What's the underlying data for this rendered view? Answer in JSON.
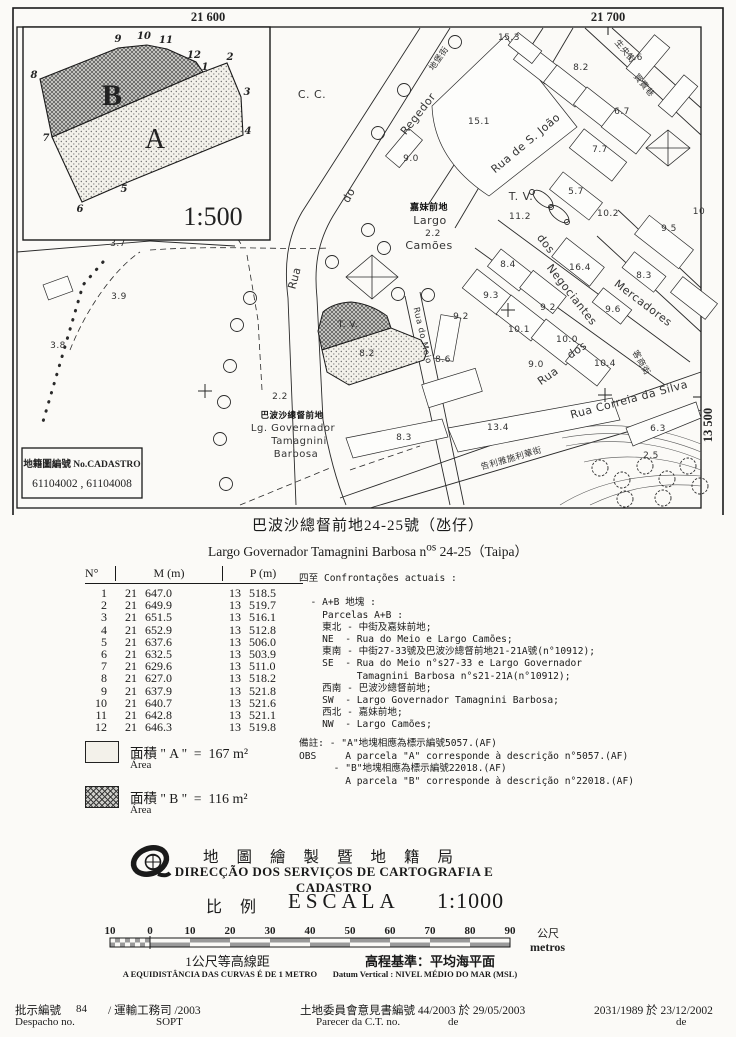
{
  "doc": {
    "title_zh": "巴波沙總督前地24-25號（氹仔）",
    "title_pt_prefix": "Largo Governador Tamagnini Barbosa n",
    "title_pt_sup": "os",
    "title_pt_rest": " 24-25（Taipa）"
  },
  "map": {
    "grid": {
      "top_left": "21 600",
      "top_right": "21 700",
      "right": "13 500"
    },
    "cadastro_box": {
      "line1": "地籍圖編號 No.CADASTRO",
      "line2": "61104002 , 61104008"
    },
    "inset": {
      "scale": "1:500",
      "label_a": "A",
      "label_b": "B",
      "a_d": "M203,72 L227,63 L241,97 L243,135 L128,182 L82,202 L52,137 Z",
      "b_d": "M40,79 L118,48 L147,45 L167,49 L196,62 L203,72 L52,137 Z",
      "vertices": [
        [
          "1",
          205,
          70
        ],
        [
          "2",
          230,
          60
        ],
        [
          "3",
          247,
          95
        ],
        [
          "4",
          248,
          134
        ],
        [
          "5",
          124,
          192
        ],
        [
          "6",
          80,
          212
        ],
        [
          "7",
          46,
          141
        ],
        [
          "8",
          34,
          78
        ],
        [
          "9",
          118,
          42
        ],
        [
          "10",
          144,
          39
        ],
        [
          "11",
          166,
          43
        ],
        [
          "12",
          194,
          58
        ]
      ]
    },
    "parcel_a_d": "M322,350 L391,328 L421,340 L427,351 L424,360 L349,385 L327,372 Z",
    "parcel_b_d": "M318,331 L323,312 Q333,303 351,302 Q371,304 387,316 L391,328 L322,350 Z",
    "streets": [
      "M420,28 L302,212 C287,238 284,266 288,298 L296,505",
      "M450,28 L333,216 C317,243 314,268 317,298 L323,420",
      "M323,420 C330,460 338,485 346,505",
      "M543,28 L428,205",
      "M573,28 L455,228",
      "M498,220 L690,362",
      "M475,248 L665,385",
      "M618,210 L701,288",
      "M597,236 L701,332",
      "M340,498 L701,372",
      "M370,508 L701,410",
      "M405,296 L450,505",
      "M420,292 L464,505",
      "M585,28 L701,135",
      "M612,28 L701,108",
      "M17,252 L150,241",
      "M150,241 L235,246"
    ],
    "dashed": [
      "M100,30 L243,247",
      "M150,250 C220,245 280,250 330,248",
      "M247,255 L258,320 L262,390",
      "M70,350 C90,300 120,265 140,252",
      "M240,505 L330,468",
      "M350,470 L420,446"
    ],
    "dotlines": [
      "M103,262 L83,285 L42,425"
    ],
    "contours": [
      "M560,430 C615,420 660,428 701,444",
      "M562,438 C615,428 662,436 701,452",
      "M566,446 C618,436 664,444 701,460",
      "M584,462 C625,452 668,458 701,470",
      "M560,505 C600,480 650,472 701,476",
      "M590,505 C625,488 660,482 701,486"
    ],
    "building_polys": [
      "M505,36 L577,127 L489,196 Q434,160 432,106 Z",
      "M448,428 L612,398 L620,420 L458,452 Z",
      "M346,438 L442,419 L448,437 L353,458 Z",
      "M626,428 L696,402 L701,418 L633,446 Z"
    ],
    "buildings": [
      [
        536,
        63,
        40,
        22,
        38
      ],
      [
        566,
        86,
        40,
        22,
        38
      ],
      [
        596,
        108,
        40,
        22,
        38
      ],
      [
        626,
        131,
        44,
        24,
        38
      ],
      [
        598,
        155,
        54,
        24,
        38
      ],
      [
        576,
        196,
        50,
        22,
        38
      ],
      [
        648,
        58,
        44,
        20,
        -50
      ],
      [
        678,
        96,
        40,
        18,
        -50
      ],
      [
        404,
        148,
        36,
        18,
        -50
      ],
      [
        525,
        48,
        30,
        16,
        38
      ],
      [
        510,
        270,
        40,
        22,
        38
      ],
      [
        543,
        292,
        42,
        22,
        38
      ],
      [
        578,
        262,
        48,
        24,
        38
      ],
      [
        644,
        272,
        40,
        20,
        38
      ],
      [
        487,
        292,
        44,
        24,
        38
      ],
      [
        521,
        318,
        44,
        24,
        38
      ],
      [
        556,
        342,
        44,
        24,
        38
      ],
      [
        588,
        365,
        40,
        22,
        38
      ],
      [
        612,
        306,
        36,
        18,
        38
      ],
      [
        664,
        242,
        56,
        24,
        38
      ],
      [
        694,
        298,
        44,
        20,
        38
      ],
      [
        452,
        388,
        56,
        24,
        -17
      ],
      [
        447,
        338,
        20,
        44,
        10
      ],
      [
        58,
        288,
        26,
        16,
        -20
      ]
    ],
    "xdiamonds": [
      "M372,255 L398,277 L372,299 L346,277 Z M346,277 L398,277 M372,255 L372,299",
      "M668,130 L690,148 L668,166 L646,148 Z M646,148 L690,148 M668,130 L668,166"
    ],
    "trees": [
      [
        455,
        42
      ],
      [
        404,
        90
      ],
      [
        378,
        133
      ],
      [
        250,
        298
      ],
      [
        237,
        325
      ],
      [
        230,
        366
      ],
      [
        224,
        402
      ],
      [
        220,
        439
      ],
      [
        226,
        484
      ],
      [
        368,
        230
      ],
      [
        384,
        248
      ],
      [
        332,
        262
      ],
      [
        398,
        294
      ],
      [
        428,
        295
      ]
    ],
    "tree_cluster": [
      [
        600,
        468
      ],
      [
        622,
        480
      ],
      [
        645,
        466
      ],
      [
        667,
        479
      ],
      [
        688,
        466
      ],
      [
        700,
        486
      ],
      [
        625,
        499
      ],
      [
        663,
        498
      ]
    ],
    "fountain_ellipses": [
      [
        543,
        199,
        40
      ],
      [
        559,
        214,
        40
      ]
    ],
    "fountain_dots": [
      [
        532,
        192
      ],
      [
        551,
        207
      ],
      [
        567,
        222
      ]
    ],
    "crosses": [
      [
        205,
        391
      ],
      [
        605,
        395
      ],
      [
        508,
        310
      ]
    ],
    "labels": [
      {
        "t": "C. C.",
        "x": 312,
        "y": 98,
        "s": 11
      },
      {
        "t": "Regedor",
        "x": 421,
        "y": 116,
        "r": -52,
        "s": 11
      },
      {
        "t": "do",
        "x": 352,
        "y": 197,
        "r": -62,
        "s": 11
      },
      {
        "t": "Rua",
        "x": 298,
        "y": 279,
        "r": -75,
        "s": 11
      },
      {
        "t": "地堡街",
        "x": 441,
        "y": 60,
        "r": -55,
        "s": 8.5
      },
      {
        "t": "Rua  de  S.  João",
        "x": 528,
        "y": 146,
        "r": -40,
        "s": 11
      },
      {
        "t": "生央街",
        "x": 623,
        "y": 53,
        "r": 50,
        "s": 8.5
      },
      {
        "t": "買賣巷",
        "x": 642,
        "y": 87,
        "r": 50,
        "s": 8.5
      },
      {
        "t": "T. V.",
        "x": 521,
        "y": 200,
        "s": 11
      },
      {
        "t": "嘉妹前地",
        "x": 429,
        "y": 210,
        "s": 9,
        "b": 1
      },
      {
        "t": "Largo",
        "x": 430,
        "y": 224,
        "s": 11
      },
      {
        "t": "2.2",
        "x": 433,
        "y": 236,
        "s": 9
      },
      {
        "t": "Camões",
        "x": 429,
        "y": 249,
        "s": 11
      },
      {
        "t": "15.1",
        "x": 479,
        "y": 124,
        "s": 9
      },
      {
        "t": "15.3",
        "x": 509,
        "y": 40,
        "s": 9
      },
      {
        "t": "8.2",
        "x": 581,
        "y": 70,
        "s": 9
      },
      {
        "t": "7.6",
        "x": 635,
        "y": 60,
        "s": 9
      },
      {
        "t": "6.7",
        "x": 622,
        "y": 114,
        "s": 9
      },
      {
        "t": "7.7",
        "x": 600,
        "y": 152,
        "s": 9
      },
      {
        "t": "5.7",
        "x": 576,
        "y": 194,
        "s": 9
      },
      {
        "t": "9.0",
        "x": 411,
        "y": 161,
        "s": 9
      },
      {
        "t": "11.2",
        "x": 520,
        "y": 219,
        "s": 9
      },
      {
        "t": "10.2",
        "x": 608,
        "y": 216,
        "s": 9
      },
      {
        "t": "9.5",
        "x": 669,
        "y": 231,
        "s": 9
      },
      {
        "t": "10",
        "x": 699,
        "y": 214,
        "s": 9
      },
      {
        "t": "dos",
        "x": 543,
        "y": 246,
        "r": 52,
        "s": 11
      },
      {
        "t": "Negociantes",
        "x": 569,
        "y": 297,
        "r": 52,
        "s": 11
      },
      {
        "t": "Mercadores",
        "x": 641,
        "y": 306,
        "r": 37,
        "s": 11
      },
      {
        "t": "客商街",
        "x": 639,
        "y": 364,
        "r": 60,
        "s": 8.5
      },
      {
        "t": "8.4",
        "x": 508,
        "y": 267,
        "s": 9
      },
      {
        "t": "16.4",
        "x": 580,
        "y": 270,
        "s": 9
      },
      {
        "t": "8.3",
        "x": 644,
        "y": 278,
        "s": 9
      },
      {
        "t": "9.3",
        "x": 491,
        "y": 298,
        "s": 9
      },
      {
        "t": "9.2",
        "x": 548,
        "y": 310,
        "s": 9
      },
      {
        "t": "9.6",
        "x": 613,
        "y": 312,
        "s": 9
      },
      {
        "t": "9.2",
        "x": 461,
        "y": 319,
        "s": 9
      },
      {
        "t": "10.1",
        "x": 519,
        "y": 332,
        "s": 9
      },
      {
        "t": "10.0",
        "x": 567,
        "y": 342,
        "s": 9
      },
      {
        "t": "10.4",
        "x": 605,
        "y": 366,
        "s": 9
      },
      {
        "t": "9.0",
        "x": 536,
        "y": 367,
        "s": 9
      },
      {
        "t": "8.6",
        "x": 443,
        "y": 362,
        "s": 9
      },
      {
        "t": "Rua",
        "x": 550,
        "y": 379,
        "r": -35,
        "s": 11
      },
      {
        "t": "dos",
        "x": 579,
        "y": 353,
        "r": -35,
        "s": 11
      },
      {
        "t": "Rua  Correia  da  Silva",
        "x": 630,
        "y": 403,
        "r": -15,
        "s": 11
      },
      {
        "t": "告利雅施利華街",
        "x": 512,
        "y": 461,
        "r": -16,
        "s": 8.5
      },
      {
        "t": "13.4",
        "x": 498,
        "y": 430,
        "s": 9
      },
      {
        "t": "8.3",
        "x": 404,
        "y": 440,
        "s": 9
      },
      {
        "t": "6.3",
        "x": 658,
        "y": 431,
        "s": 9
      },
      {
        "t": "2.5",
        "x": 651,
        "y": 458,
        "s": 9
      },
      {
        "t": "Rua do Meio",
        "x": 420,
        "y": 336,
        "r": 77,
        "s": 8.5
      },
      {
        "t": "T. V.",
        "x": 348,
        "y": 327,
        "s": 9
      },
      {
        "t": "8.2",
        "x": 367,
        "y": 356,
        "s": 9
      },
      {
        "t": "2.2",
        "x": 280,
        "y": 399,
        "s": 9
      },
      {
        "t": "巴波沙總督前地",
        "x": 292,
        "y": 418,
        "s": 8.5,
        "b": 1
      },
      {
        "t": "Lg. Governador",
        "x": 293,
        "y": 431,
        "s": 10
      },
      {
        "t": "Tamagnini",
        "x": 299,
        "y": 444,
        "s": 10
      },
      {
        "t": "Barbosa",
        "x": 296,
        "y": 457,
        "s": 10
      },
      {
        "t": "3.7",
        "x": 118,
        "y": 246,
        "s": 9
      },
      {
        "t": "3.9",
        "x": 119,
        "y": 299,
        "s": 9
      },
      {
        "t": "3.8",
        "x": 58,
        "y": 348,
        "s": 9
      }
    ]
  },
  "table": {
    "headers": [
      "N°",
      "M (m)",
      "P (m)"
    ],
    "rows": [
      [
        "1",
        "21 647.0",
        "13 518.5"
      ],
      [
        "2",
        "21 649.9",
        "13 519.7"
      ],
      [
        "3",
        "21 651.5",
        "13 516.1"
      ],
      [
        "4",
        "21 652.9",
        "13 512.8"
      ],
      [
        "5",
        "21 637.6",
        "13 506.0"
      ],
      [
        "6",
        "21 632.5",
        "13 503.9"
      ],
      [
        "7",
        "21 629.6",
        "13 511.0"
      ],
      [
        "8",
        "21 627.0",
        "13 518.2"
      ],
      [
        "9",
        "21 637.9",
        "13 521.8"
      ],
      [
        "10",
        "21 640.7",
        "13 521.6"
      ],
      [
        "11",
        "21 642.8",
        "13 521.1"
      ],
      [
        "12",
        "21 646.3",
        "13 519.8"
      ]
    ]
  },
  "confrontations": {
    "lines": [
      "四至 Confrontações actuais :",
      "",
      "  - A+B 地塊 :",
      "    Parcelas A+B :",
      "    東北 - 中街及嘉妹前地;",
      "    NE  - Rua do Meio e Largo Camões;",
      "    東南 - 中街27-33號及巴波沙總督前地21-21A號(n°10912);",
      "    SE  - Rua do Meio n°s27-33 e Largo Governador",
      "          Tamagnini Barbosa n°s21-21A(n°10912);",
      "    西南 - 巴波沙總督前地;",
      "    SW  - Largo Governador Tamagnini Barbosa;",
      "    西北 - 嘉妹前地;",
      "    NW  - Largo Camões;"
    ],
    "obs_lines": [
      "備註: - \"A\"地塊相應為標示編號5057.(AF)",
      "OBS     A parcela \"A\" corresponde à descrição n°5057.(AF)",
      "      - \"B\"地塊相應為標示編號22018.(AF)",
      "        A parcela \"B\" corresponde à descrição n°22018.(AF)"
    ]
  },
  "areas": [
    {
      "zh": "面積",
      "rest": " \" A \"  =",
      "value": "  167 m²",
      "sub": "Área"
    },
    {
      "zh": "面積",
      "rest": " \" B \"  =",
      "value": "  116 m²",
      "sub": "Área"
    }
  ],
  "agency": {
    "name_zh": "地圖繪製暨地籍局",
    "name_pt": "DIRECÇÃO DOS SERVIÇOS DE CARTOGRAFIA E CADASTRO",
    "scale_zh": "比 例",
    "scale_word": "ESCALA",
    "scale_value": "1:1000"
  },
  "scalebar": {
    "ticks": [
      "10",
      "0",
      "10",
      "20",
      "30",
      "40",
      "50",
      "60",
      "70",
      "80",
      "90"
    ],
    "unit_zh": "公尺",
    "unit_pt": "metros",
    "equidistance_zh": "1公尺等高線距",
    "equidistance_pt": "A EQUIDISTÂNCIA DAS CURVAS É DE 1 METRO",
    "datum_zh": "高程基準：平均海平面",
    "datum_pt": "Datum Vertical : NIVEL MÉDIO DO MAR (MSL)"
  },
  "footer": {
    "items": [
      {
        "t": "批示編號",
        "x": 15,
        "y": 1002,
        "c": "fzh"
      },
      {
        "t": "84",
        "x": 76,
        "y": 1003,
        "c": "flat"
      },
      {
        "t": "/ 運輸工務司 /2003",
        "x": 108,
        "y": 1002,
        "c": "fzh"
      },
      {
        "t": "Despacho no.",
        "x": 15,
        "y": 1016,
        "c": "flat"
      },
      {
        "t": "SOPT",
        "x": 156,
        "y": 1016,
        "c": "flat"
      },
      {
        "t": "土地委員會意見書編號 44/2003 於 29/05/2003",
        "x": 300,
        "y": 1002,
        "c": "fzh"
      },
      {
        "t": "Parecer da C.T. no.",
        "x": 316,
        "y": 1016,
        "c": "flat"
      },
      {
        "t": "de",
        "x": 448,
        "y": 1016,
        "c": "flat"
      },
      {
        "t": "2031/1989 於 23/12/2002",
        "x": 594,
        "y": 1002,
        "c": "fzh"
      },
      {
        "t": "de",
        "x": 676,
        "y": 1016,
        "c": "flat"
      }
    ]
  }
}
